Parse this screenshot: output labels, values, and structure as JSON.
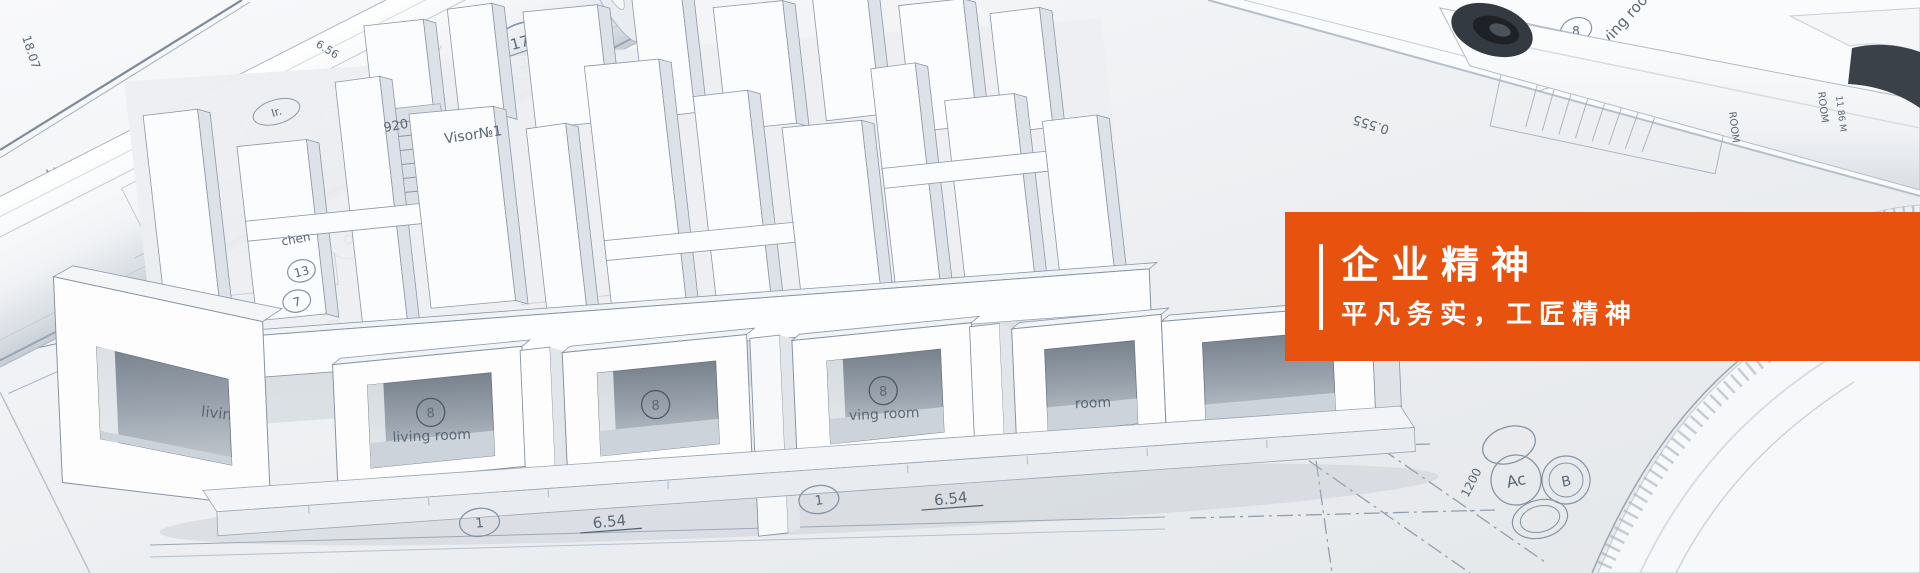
{
  "banner": {
    "width": 1920,
    "height": 573,
    "overlay": {
      "title": "企业精神",
      "subtitle": "平凡务实，工匠精神",
      "background_color": "#e8520f",
      "divider_color": "#ffffff",
      "text_color": "#ffffff"
    },
    "scene": {
      "description": "photo of rolled architectural blueprints with a white 3D floor-plan model",
      "labels": {
        "living_room": "living room",
        "ving_room": "ving room",
        "room": "room",
        "kitchen_fragment": "chen",
        "visor": "Visor№1",
        "num_920": "920",
        "ir": "Ir.",
        "room_caps": "ROOM",
        "room_area": "11 86 M",
        "dim_654": "6.54",
        "dim_1807": "18.07",
        "dim_125": "1.25",
        "dim_84": "8.4",
        "dim_656": "6.56",
        "dim_0555": "0.555",
        "dim_6300": "6.300",
        "dim_1200": "1200",
        "dim_1750_side": "17.50",
        "stamp_a": {
          "floor": "1",
          "area": "17.50",
          "total": "35.13"
        },
        "stamp_b": {
          "floor": "1",
          "area": "16.59",
          "total": "35.33"
        },
        "circle_1": "1",
        "circle_3": "3",
        "circle_6": "6",
        "circle_7": "7",
        "circle_8": "8",
        "circle_9": "9",
        "circle_13": "13",
        "marker_ac": "Ac",
        "marker_b": "B"
      }
    }
  }
}
